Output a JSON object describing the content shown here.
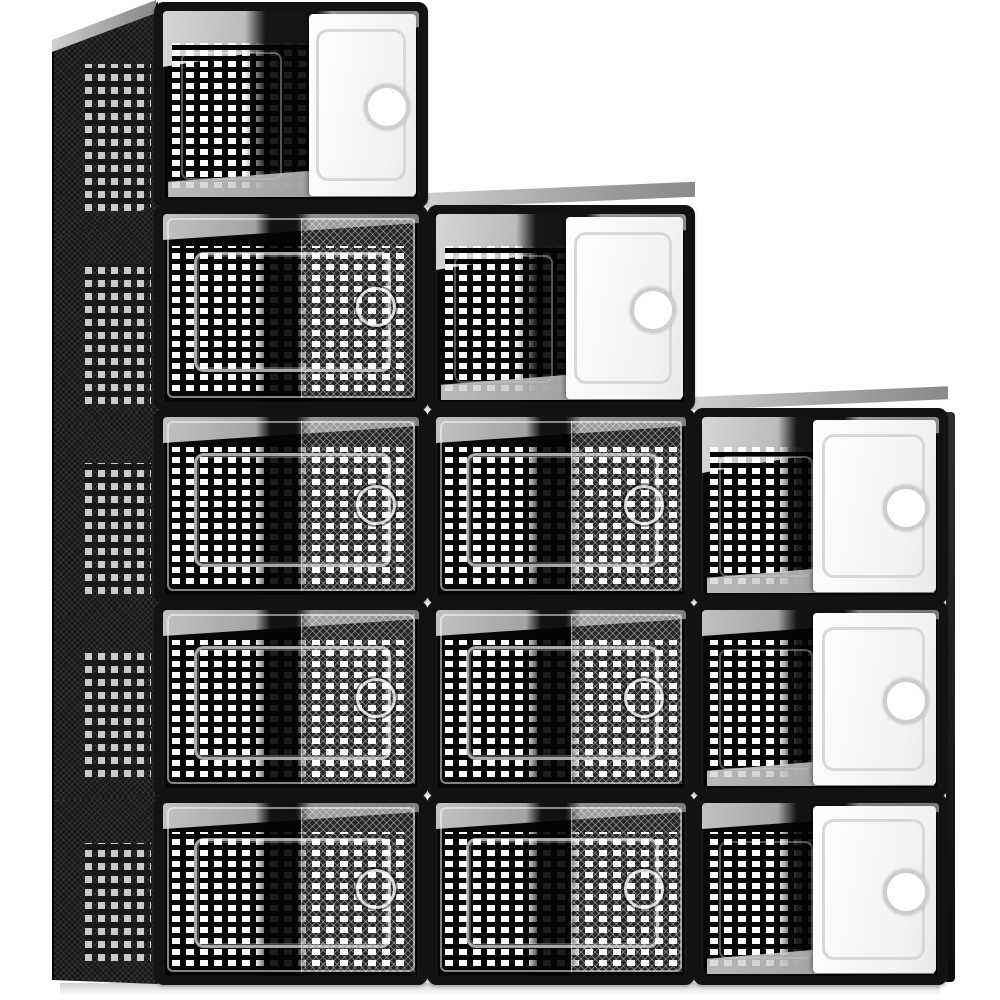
{
  "image_type": "product-photo",
  "subject": "12-pack stackable clear plastic shoe storage boxes with black frames, perforated panels and drop-front doors, arranged in a staircase stack",
  "background_color": "#ffffff",
  "palette": {
    "frame": "#121212",
    "interior": "#060606",
    "perforation_holes": "#fafafa",
    "side_panel": "#181818",
    "open_door": "#f3f3f3",
    "door_reflection": "rgba(255,255,255,0.13)",
    "top_face": "#cfcfcf"
  },
  "stack": {
    "total_boxes": 12,
    "columns": [
      {
        "index": 1,
        "x": 154,
        "width": 274,
        "rows_present": [
          1,
          2,
          3,
          4,
          5
        ]
      },
      {
        "index": 2,
        "x": 427,
        "width": 268,
        "rows_present": [
          2,
          3,
          4,
          5
        ]
      },
      {
        "index": 3,
        "x": 693,
        "width": 255,
        "rows_present": [
          3,
          4,
          5
        ]
      }
    ],
    "row_tops": [
      2,
      205,
      408,
      601,
      794
    ],
    "row_heights": [
      206,
      206,
      196,
      196,
      191
    ]
  },
  "boxes": [
    {
      "id": "c1-r1",
      "col": 1,
      "row": 1,
      "x": 154,
      "y": 2,
      "w": 274,
      "h": 206,
      "door": "open",
      "column_top": true,
      "panel_left_pct": 57
    },
    {
      "id": "c1-r2",
      "col": 1,
      "row": 2,
      "x": 154,
      "y": 205,
      "w": 274,
      "h": 206,
      "door": "closed",
      "column_top": false
    },
    {
      "id": "c1-r3",
      "col": 1,
      "row": 3,
      "x": 154,
      "y": 408,
      "w": 274,
      "h": 196,
      "door": "closed",
      "column_top": false
    },
    {
      "id": "c1-r4",
      "col": 1,
      "row": 4,
      "x": 154,
      "y": 601,
      "w": 274,
      "h": 196,
      "door": "closed",
      "column_top": false
    },
    {
      "id": "c1-r5",
      "col": 1,
      "row": 5,
      "x": 154,
      "y": 794,
      "w": 274,
      "h": 191,
      "door": "closed",
      "column_top": false
    },
    {
      "id": "c2-r2",
      "col": 2,
      "row": 2,
      "x": 427,
      "y": 205,
      "w": 268,
      "h": 206,
      "door": "open",
      "column_top": true,
      "panel_left_pct": 52
    },
    {
      "id": "c2-r3",
      "col": 2,
      "row": 3,
      "x": 427,
      "y": 408,
      "w": 268,
      "h": 196,
      "door": "closed",
      "column_top": false
    },
    {
      "id": "c2-r4",
      "col": 2,
      "row": 4,
      "x": 427,
      "y": 601,
      "w": 268,
      "h": 196,
      "door": "closed",
      "column_top": false
    },
    {
      "id": "c2-r5",
      "col": 2,
      "row": 5,
      "x": 427,
      "y": 794,
      "w": 268,
      "h": 191,
      "door": "closed",
      "column_top": false
    },
    {
      "id": "c3-r3",
      "col": 3,
      "row": 3,
      "x": 693,
      "y": 408,
      "w": 255,
      "h": 196,
      "door": "open",
      "column_top": true,
      "panel_left_pct": 47
    },
    {
      "id": "c3-r4",
      "col": 3,
      "row": 4,
      "x": 693,
      "y": 601,
      "w": 255,
      "h": 196,
      "door": "open",
      "column_top": false,
      "panel_left_pct": 47
    },
    {
      "id": "c3-r5",
      "col": 3,
      "row": 5,
      "x": 693,
      "y": 794,
      "w": 255,
      "h": 191,
      "door": "open",
      "column_top": false,
      "panel_left_pct": 47
    }
  ],
  "side_panels": {
    "x": 52,
    "width": 104,
    "segments": [
      {
        "id": "side-r1",
        "top": 2,
        "height": 238,
        "clip": "polygon(0 42px,100% 0,100% 204px,0 238px)"
      },
      {
        "id": "side-r2",
        "top": 205,
        "height": 226,
        "clip": "polygon(0 35px,100% 0,100% 205px,0 226px)"
      },
      {
        "id": "side-r3",
        "top": 408,
        "height": 211,
        "clip": "polygon(0 22px,100% 0,100% 195px,0 211px)"
      },
      {
        "id": "side-r4",
        "top": 601,
        "height": 200,
        "clip": "polygon(0 17px,100% 0,100% 194px,0 200px)"
      },
      {
        "id": "side-r5",
        "top": 794,
        "height": 190,
        "clip": "polygon(0 7px,100% 0,100% 190px,0 186px)"
      }
    ]
  },
  "top_faces": [
    {
      "id": "top-face-col1",
      "x": 52,
      "y": 0,
      "w": 104,
      "h": 52,
      "clip": "polygon(0 40px,100% 0,100% 13px,0 52px)"
    },
    {
      "id": "top-face-col2",
      "x": 426,
      "y": 193,
      "w": 269,
      "h": 15,
      "skew": -2.4
    },
    {
      "id": "top-face-col3",
      "x": 692,
      "y": 397,
      "w": 256,
      "h": 13,
      "skew": -2.4
    }
  ],
  "right_edge_face": {
    "x": 946,
    "y": 412,
    "w": 9,
    "h": 570
  },
  "ground_shadow": {
    "x": 60,
    "y": 983,
    "w": 880,
    "h": 12
  },
  "details": {
    "finger_hole_x_pct": 82,
    "mesh_start_pct": 54,
    "grid_region_pct": {
      "left": 3.5,
      "right": 3.5,
      "top": 17,
      "bottom": 6
    }
  }
}
